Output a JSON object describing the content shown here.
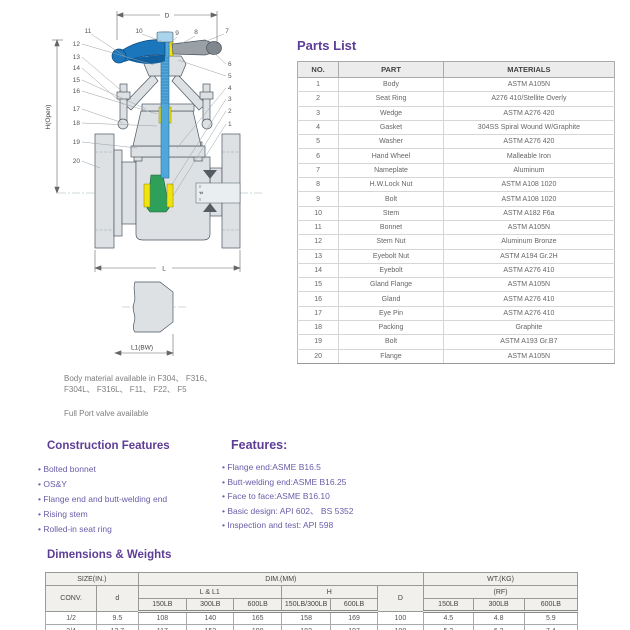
{
  "colors": {
    "accent": "#5e3d96",
    "feature_text": "#6b5ca8",
    "handwheel_blue": "#1b76bc",
    "stem_blue": "#4fa8da",
    "wedge_green": "#2fa05a",
    "seal_yellow": "#f2e30e",
    "metal_gray": "#dde1e4"
  },
  "diagram": {
    "dims": {
      "d_top": "D",
      "h_left": "H(Open)",
      "l_bottom": "L",
      "l1": "L1(BW)",
      "bore": "d"
    },
    "callouts": {
      "top": [
        "11",
        "10",
        "9",
        "8",
        "7"
      ],
      "left": [
        "12",
        "13",
        "14",
        "15",
        "16",
        "17",
        "18",
        "19",
        "20"
      ],
      "right": [
        "6",
        "5",
        "4",
        "3",
        "2",
        "1"
      ]
    },
    "notes": [
      "Body material available in F304、 F316、",
      "F304L、 F316L、 F11、 F22、 F5",
      "Full Port valve available"
    ]
  },
  "parts_list": {
    "title": "Parts List",
    "headers": [
      "NO.",
      "PART",
      "MATERIALS"
    ],
    "rows": [
      [
        "1",
        "Body",
        "ASTM A105N"
      ],
      [
        "2",
        "Seat Ring",
        "A276 410/Stellite Overly"
      ],
      [
        "3",
        "Wedge",
        "ASTM A276 420"
      ],
      [
        "4",
        "Gasket",
        "304SS Spiral Wound W/Graphite"
      ],
      [
        "5",
        "Washer",
        "ASTM A276 420"
      ],
      [
        "6",
        "Hand Wheel",
        "Malleable Iron"
      ],
      [
        "7",
        "Nameplate",
        "Aluminum"
      ],
      [
        "8",
        "H.W.Lock Nut",
        "ASTM A108 1020"
      ],
      [
        "9",
        "Bolt",
        "ASTM A108 1020"
      ],
      [
        "10",
        "Stem",
        "ASTM A182 F6a"
      ],
      [
        "11",
        "Bonnet",
        "ASTM A105N"
      ],
      [
        "12",
        "Stem Nut",
        "Aluminum Bronze"
      ],
      [
        "13",
        "Eyebolt Nut",
        "ASTM A194 Gr.2H"
      ],
      [
        "14",
        "Eyebolt",
        "ASTM A276 410"
      ],
      [
        "15",
        "Gland Flange",
        "ASTM A105N"
      ],
      [
        "16",
        "Gland",
        "ASTM A276 410"
      ],
      [
        "17",
        "Eye Pin",
        "ASTM A276 410"
      ],
      [
        "18",
        "Packing",
        "Graphite"
      ],
      [
        "19",
        "Bolt",
        "ASTM A193 Gr.B7"
      ],
      [
        "20",
        "Flange",
        "ASTM A105N"
      ]
    ]
  },
  "construction_features": {
    "title": "Construction Features",
    "items": [
      "Bolted bonnet",
      "OS&Y",
      "Flange end and butt-welding end",
      "Rising stem",
      "Rolled-in seat ring"
    ]
  },
  "features": {
    "title": "Features:",
    "items": [
      "Flange end:ASME B16.5",
      "Butt-welding end:ASME B16.25",
      "Face to face:ASME B16.10",
      "Basic design: API 602、 BS 5352",
      "Inspection and test: API 598"
    ]
  },
  "dimensions": {
    "title": "Dimensions & Weights",
    "header": {
      "size": "SIZE(IN.)",
      "dim": "DIM.(MM)",
      "wt": "WT.(KG)",
      "conv": "CONV.",
      "d": "d",
      "l_l1": "L & L1",
      "h": "H",
      "D": "D",
      "rf": "(RF)",
      "sub": [
        "150LB",
        "300LB",
        "600LB",
        "150LB/300LB",
        "600LB",
        "150LB",
        "300LB",
        "600LB"
      ]
    },
    "rows": [
      [
        "1/2",
        "9.5",
        "108",
        "140",
        "165",
        "158",
        "169",
        "100",
        "4.5",
        "4.8",
        "5.9"
      ],
      [
        "3/4",
        "12.7",
        "117",
        "152",
        "190",
        "183",
        "197",
        "100",
        "5.3",
        "6.3",
        "7.4"
      ]
    ]
  }
}
